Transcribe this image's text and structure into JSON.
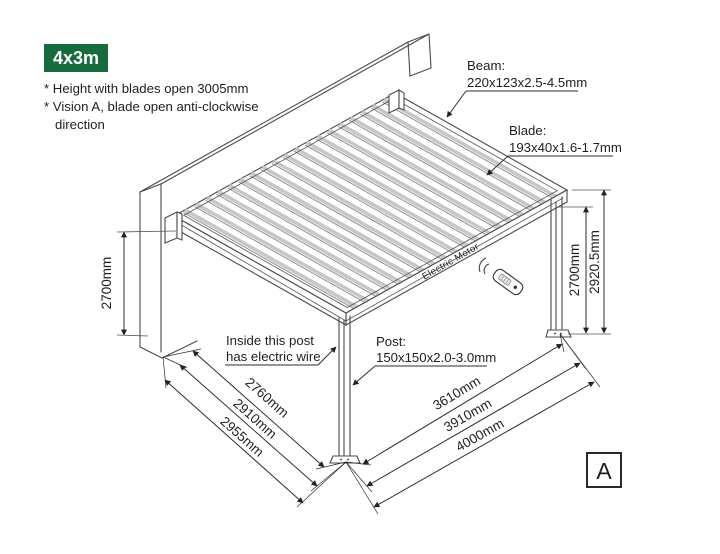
{
  "badge": {
    "label": "4x3m",
    "bg_color": "#176B3F",
    "text_color": "#ffffff"
  },
  "notes": {
    "line1": "* Height with blades open 3005mm",
    "line2": "* Vision A, blade open anti-clockwise",
    "line3": "direction"
  },
  "callouts": {
    "beam_title": "Beam:",
    "beam_spec": "220x123x2.5-4.5mm",
    "blade_title": "Blade:",
    "blade_spec": "193x40x1.6-1.7mm",
    "post_title": "Post:",
    "post_spec": "150x150x2.0-3.0mm",
    "wire_line1": "Inside this post",
    "wire_line2": "has electric wire"
  },
  "dimensions": {
    "left_wall_height": "2700mm",
    "right_post_height": "2700mm",
    "right_total_height": "2920.5mm",
    "left_span_1": "2760mm",
    "left_span_2": "2910mm",
    "left_span_3": "2955mm",
    "right_span_1": "3610mm",
    "right_span_2": "3910mm",
    "right_span_3": "4000mm"
  },
  "labels": {
    "motor": "Electric Motor",
    "view": "A"
  },
  "line_color": "#4a4a4a"
}
